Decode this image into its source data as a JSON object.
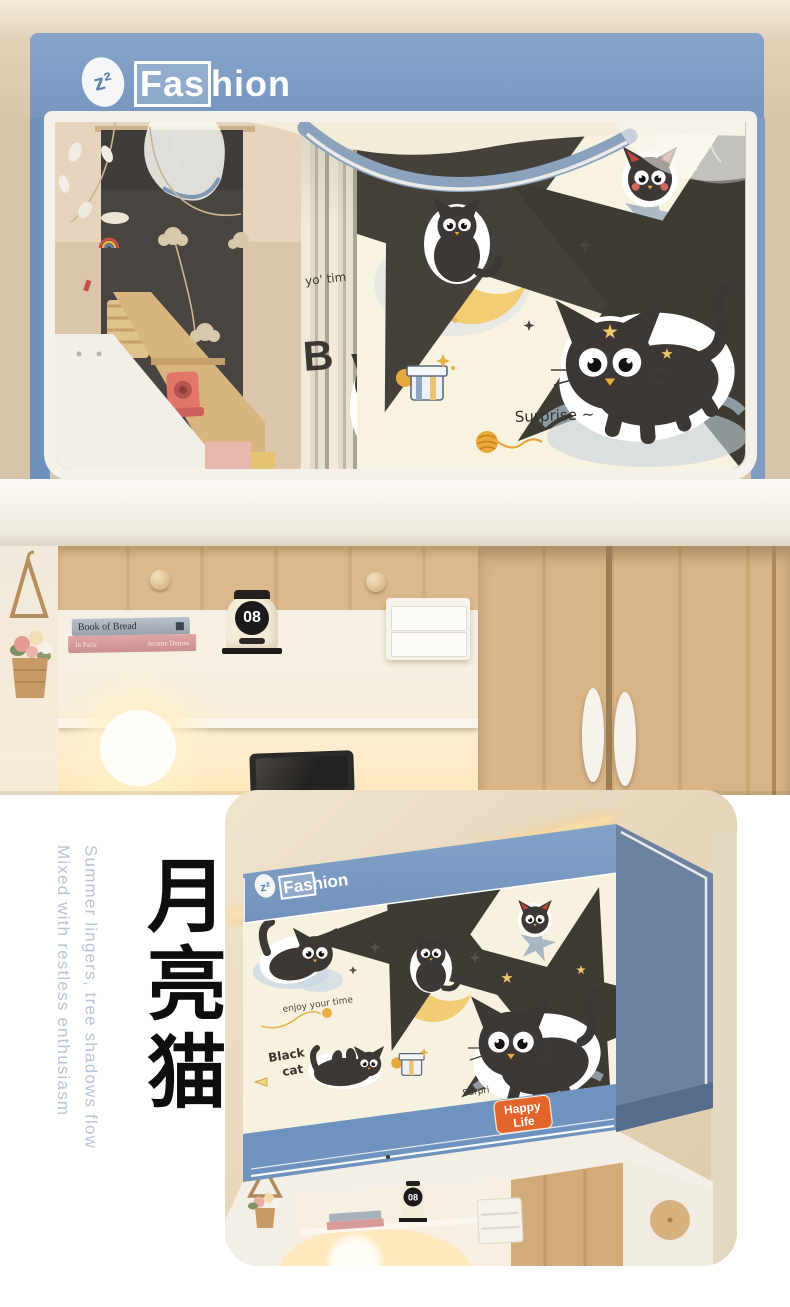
{
  "brand": {
    "icon_text": "z²",
    "name_boxed": "Fas",
    "name_rest": "hion"
  },
  "colors": {
    "canopy_blue": "#7E9DC6",
    "canopy_side": "#6B83A1",
    "curtain_cream": "#F7F1DF",
    "badge_orange": "#E2662B",
    "wood": "#D7B385",
    "wall_beige": "#DCC9AE",
    "glow_warm": "#FFE2A0",
    "tagline_blue": "#B6C5D8",
    "cat_black": "#3D3834",
    "moon_yellow": "#F3CD74"
  },
  "top_photo": {
    "print": {
      "surprise": "Surprise ~",
      "pleat_script": "yo' tim",
      "pleat_letter": "B"
    },
    "shelf": {
      "book_top_title": "Book of Bread",
      "book_bottom_title": "In Paris",
      "book_bottom_author": "Jerome Dumas",
      "clock_digits": "08"
    }
  },
  "bottom_section": {
    "tagline_line1": "Summer lingers, tree shadows flow",
    "tagline_line2": "Mixed with restless enthusiasm",
    "title_cn": "月亮猫",
    "card": {
      "print": {
        "enjoy": "enjoy your time",
        "black_cat_word1": "Black",
        "black_cat_word2": "cat",
        "surprise_partial": "Surpri"
      },
      "badge_line1": "Happy",
      "badge_line2": "Life",
      "clock_digits": "08"
    }
  }
}
